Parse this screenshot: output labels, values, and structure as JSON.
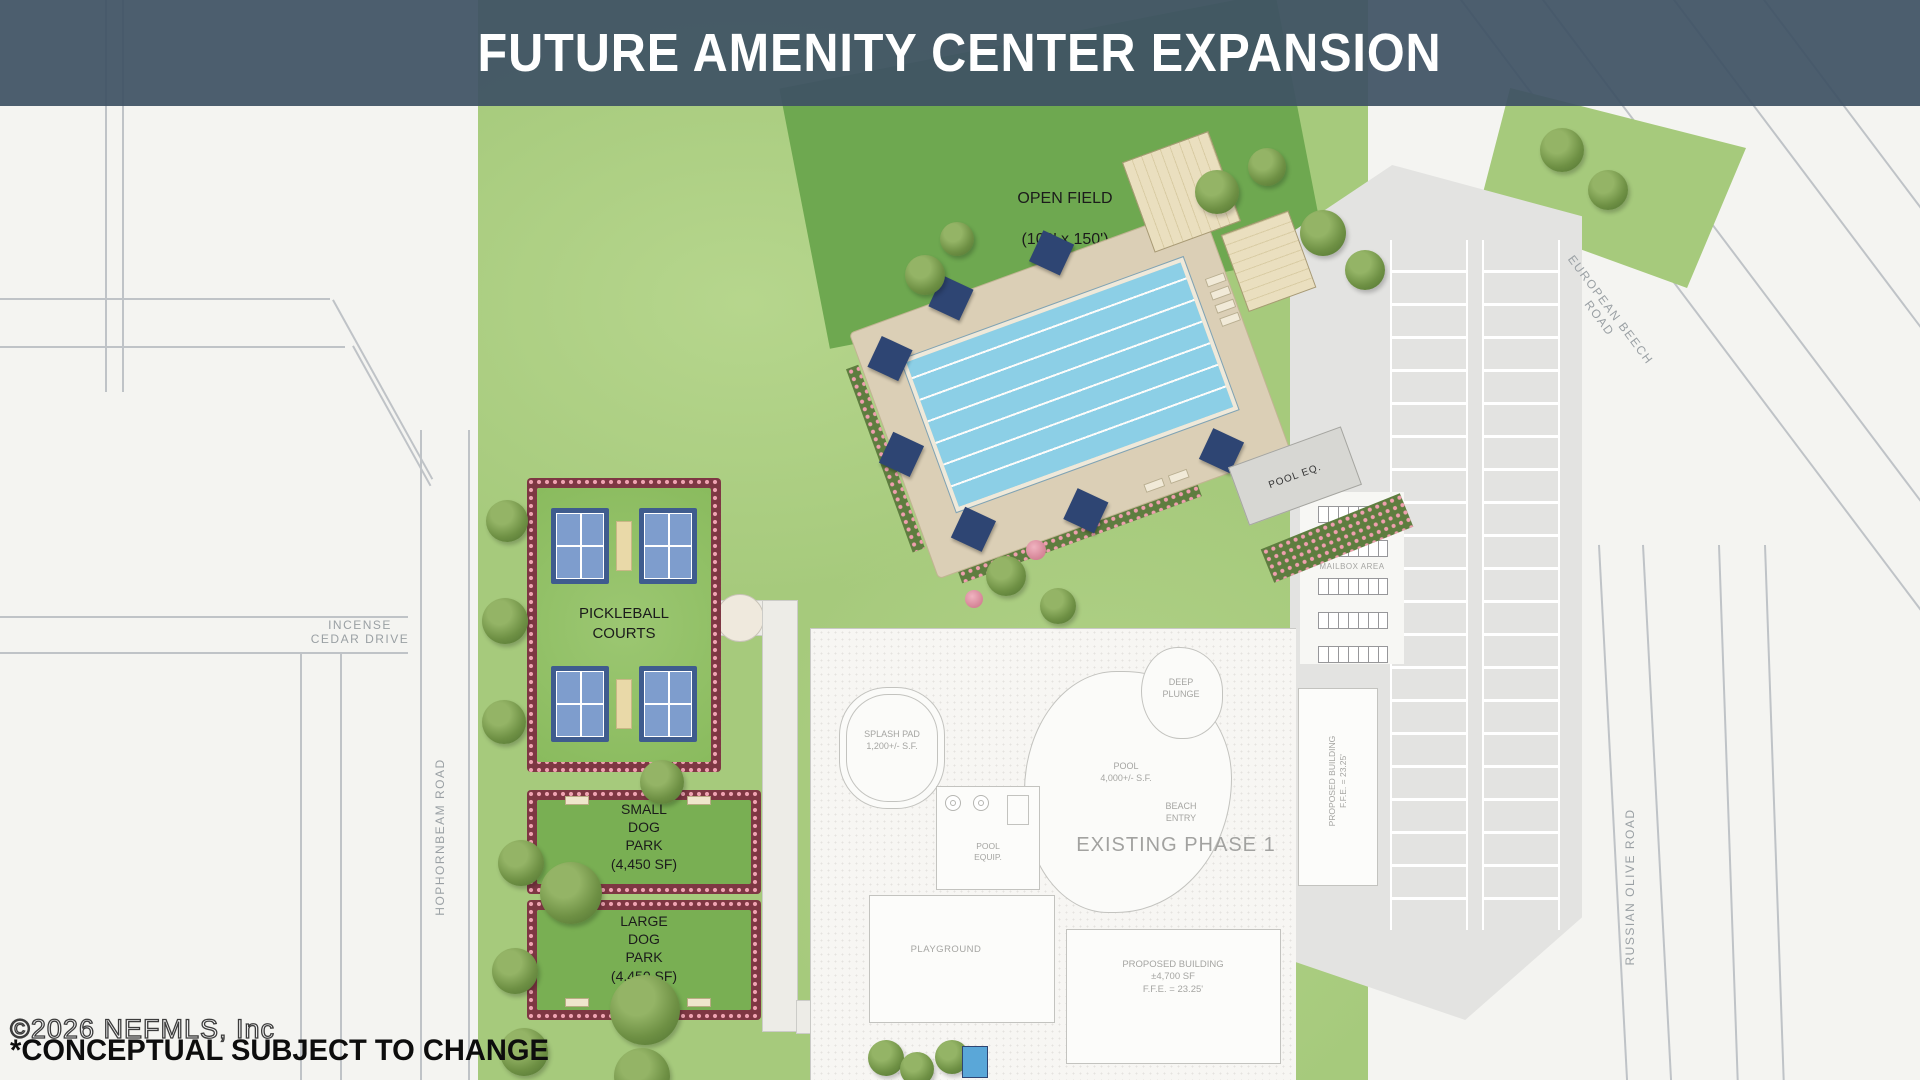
{
  "header": {
    "title": "FUTURE AMENITY CENTER EXPANSION"
  },
  "site": {
    "open_field": {
      "label": "OPEN FIELD",
      "size": "(100' x 150')"
    },
    "pickleball_label": "PICKLEBALL\nCOURTS",
    "small_dog_park_label": "SMALL\nDOG\nPARK\n(4,450 SF)",
    "large_dog_park_label": "LARGE\nDOG\nPARK\n(4,450 SF)",
    "pool_eq_label": "POOL EQ."
  },
  "existing": {
    "title": "EXISTING PHASE 1",
    "splash_pad": "SPLASH PAD\n1,200+/- S.F.",
    "pool": "POOL\n4,000+/- S.F.",
    "beach_entry": "BEACH\nENTRY",
    "deep_plunge": "DEEP\nPLUNGE",
    "pool_equip": "POOL\nEQUIP.",
    "playground": "PLAYGROUND",
    "proposed_building_main": "PROPOSED BUILDING\n±4,700 SF\nF.F.E. = 23.25'",
    "proposed_building_east": "PROPOSED BUILDING\nF.F.E. = 23.25'",
    "mailbox_area": "MAILBOX AREA"
  },
  "roads": {
    "incense_cedar": "INCENSE\nCEDAR DRIVE",
    "hophornbeam": "HOPHORNBEAM ROAD",
    "european_beech": "EUROPEAN BEECH\nROAD",
    "russian_olive": "RUSSIAN OLIVE ROAD"
  },
  "footer": {
    "watermark": "©2026 NEFMLS, Inc",
    "disclaimer": "*CONCEPTUAL SUBJECT TO CHANGE"
  },
  "colors": {
    "header_bg": "#3e5264",
    "lawn_green": "#a6ca7c",
    "open_field_green": "#6ea850",
    "dog_park_green": "#79af53",
    "hedge_maroon": "#7e3743",
    "hedge_pink": "#efa3b2",
    "court_blue": "#3f5c8e",
    "court_inner_blue": "#7e9dcd",
    "pool_blue": "#8ccfe6",
    "deck_tan": "#dbcfb6",
    "shade_sail_navy": "#2e4573",
    "parking_gray": "#e3e3e1",
    "cad_line_gray": "#c3c3bf"
  }
}
